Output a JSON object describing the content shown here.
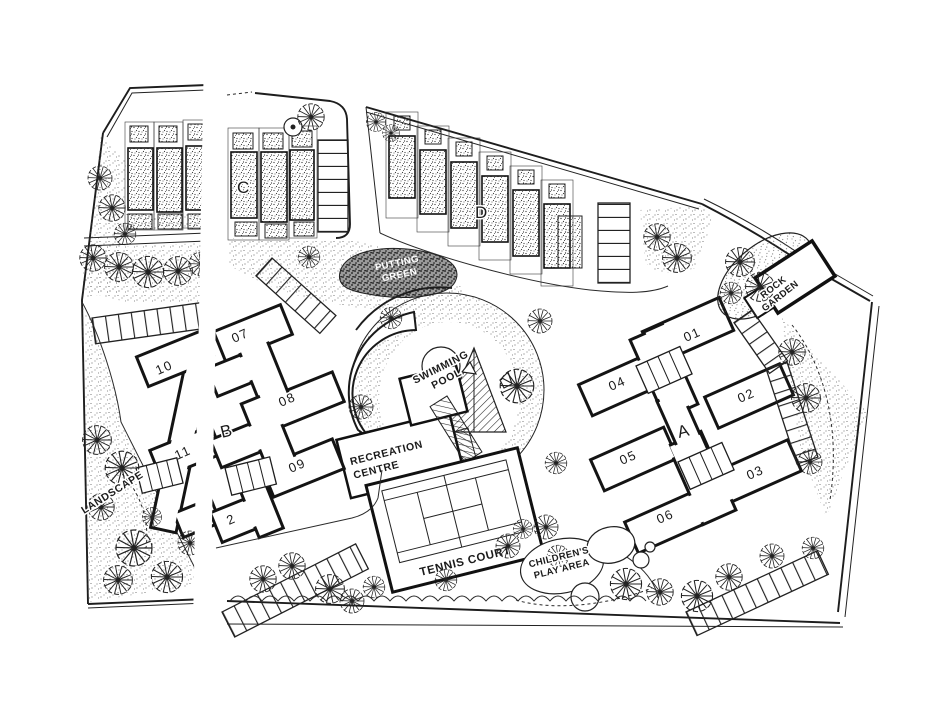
{
  "plan_labels": {
    "buildings": {
      "a": "A",
      "b": "B",
      "c": "C",
      "d": "D"
    },
    "units": {
      "u01": "01",
      "u02": "02",
      "u03": "03",
      "u04": "04",
      "u05": "05",
      "u06": "06",
      "u07": "07",
      "u08": "08",
      "u09": "09",
      "u10": "10",
      "u11": "11",
      "u12_partial": "2"
    },
    "amenities": {
      "swimming_pool_line1": "SWIMMING",
      "swimming_pool_line2": "POOL",
      "recreation_centre_line1": "RECREATION",
      "recreation_centre_line2": "CENTRE",
      "tennis_court": "TENNIS COURT",
      "putting_green_line1": "PUTTING",
      "putting_green_line2": "GREEN",
      "rock_garden_line1": "ROCK",
      "rock_garden_line2": "GARDEN",
      "childrens_play_area_line1": "CHILDREN'S",
      "childrens_play_area_line2": "PLAY AREA",
      "landscape": "LANDSCAPE"
    }
  },
  "colors": {
    "ink": "#1a1a1a",
    "paper": "#ffffff"
  }
}
